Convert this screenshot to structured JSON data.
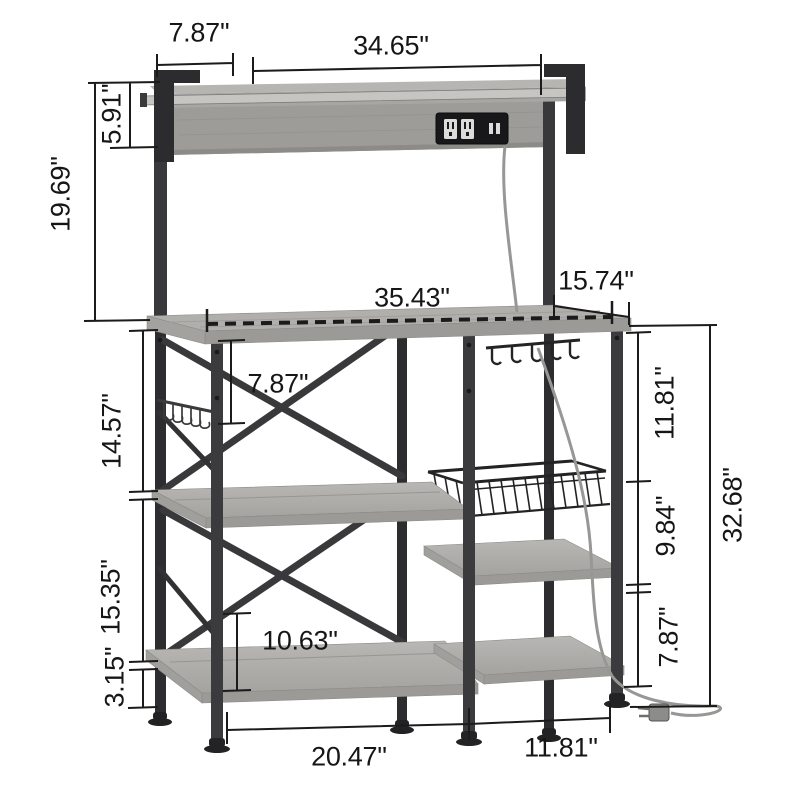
{
  "diagram": {
    "subject": "bakers-rack-with-power-outlet-dimension-diagram",
    "unit": "inches",
    "background": "#ffffff",
    "colors": {
      "wood_light": "#b6b5b2",
      "wood": "#a7a6a3",
      "wood_dark": "#9b9a97",
      "frame": "#39393b",
      "frame_dark": "#28282a",
      "dimension_line": "#1b1b1b",
      "cord": "#979795",
      "rail": "#c6c5c2"
    },
    "dimensions": [
      {
        "id": "top-shelf-depth",
        "label": "7.87''",
        "orientation": "horizontal"
      },
      {
        "id": "top-shelf-width",
        "label": "34.65''",
        "orientation": "horizontal"
      },
      {
        "id": "hutch-board-height",
        "label": "5.91''",
        "orientation": "vertical"
      },
      {
        "id": "hutch-height",
        "label": "19.69''",
        "orientation": "vertical"
      },
      {
        "id": "worktop-width",
        "label": "35.43''",
        "orientation": "horizontal"
      },
      {
        "id": "worktop-depth",
        "label": "15.74''",
        "orientation": "horizontal"
      },
      {
        "id": "under-worktop-clearance",
        "label": "7.87''",
        "orientation": "horizontal"
      },
      {
        "id": "left-upper-gap",
        "label": "14.57''",
        "orientation": "vertical"
      },
      {
        "id": "left-mid-gap",
        "label": "15.35''",
        "orientation": "vertical"
      },
      {
        "id": "left-foot-height",
        "label": "3.15''",
        "orientation": "vertical"
      },
      {
        "id": "lower-shelf-gap",
        "label": "10.63''",
        "orientation": "horizontal"
      },
      {
        "id": "right-upper-gap",
        "label": "11.81''",
        "orientation": "vertical"
      },
      {
        "id": "right-mid-gap",
        "label": "9.84''",
        "orientation": "vertical"
      },
      {
        "id": "right-lower-gap",
        "label": "7.87''",
        "orientation": "vertical"
      },
      {
        "id": "lower-total-height",
        "label": "32.68''",
        "orientation": "vertical"
      },
      {
        "id": "bottom-left-width",
        "label": "20.47''",
        "orientation": "horizontal"
      },
      {
        "id": "bottom-right-width",
        "label": "11.81''",
        "orientation": "horizontal"
      }
    ],
    "icons": [
      "power-outlet-strip",
      "usb-ports",
      "power-plug",
      "wire-basket",
      "side-hooks",
      "mug-hooks",
      "x-brace"
    ]
  }
}
